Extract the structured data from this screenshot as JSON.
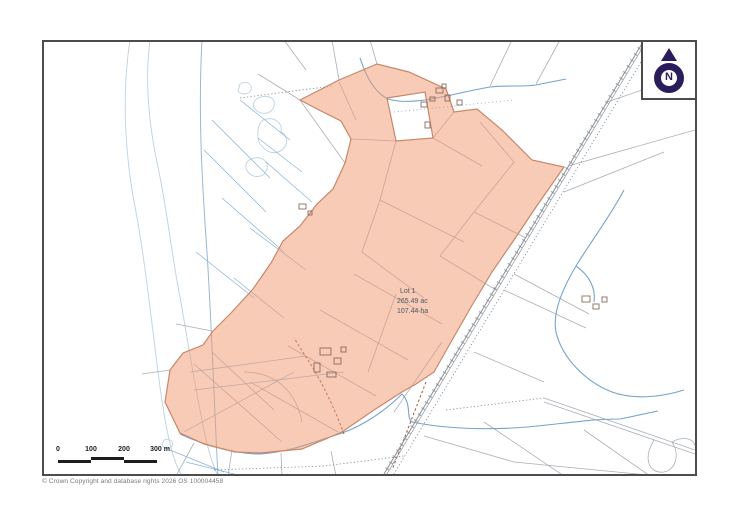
{
  "map": {
    "parcel_label": {
      "lot": "Lot 1",
      "acres": "265.49 ac",
      "hectares": "107.44 ha"
    },
    "compass_letter": "N",
    "scale_bar": {
      "ticks": [
        "0",
        "100",
        "200",
        "300 m"
      ]
    },
    "copyright": "© Crown Copyright and database rights 2026 OS 100004458"
  },
  "colors": {
    "parcel_fill": "#f8cdb8",
    "parcel_outline": "#c8876b",
    "stream_blue": "#76a3cb",
    "ditch_blue": "#8cb2d4",
    "coast_blue": "#c3d5e2",
    "boundary_gray": "#a9afb7",
    "railway_gray": "#8a9098",
    "track_brown": "#a2583c",
    "compass_indigo": "#2b1d5c",
    "frame_border": "#4c4c4c",
    "label_text": "#4d5868",
    "scale_black": "#1d1d1d"
  }
}
